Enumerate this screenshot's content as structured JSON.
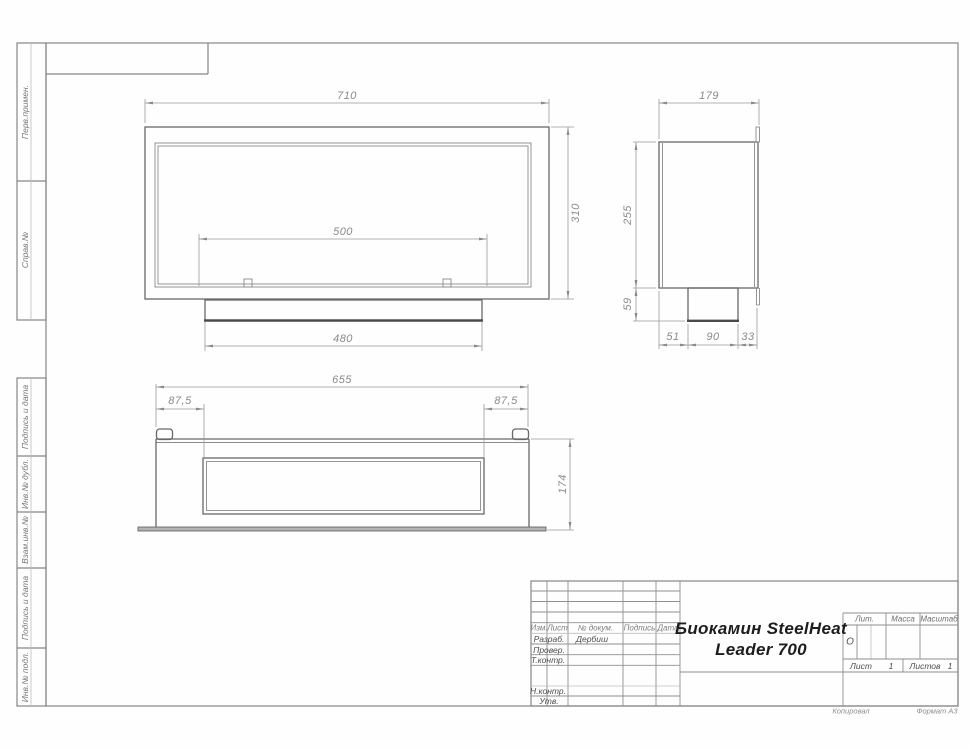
{
  "margin_labels": [
    "Перв.примен.",
    "Справ.№",
    "Подпись и дата",
    "Инв.№ дубл.",
    "Взам.инв.№",
    "Подпись и дата",
    "Инв.№ подл."
  ],
  "views": {
    "front": {
      "width": "710",
      "height": "310",
      "burner_width": "500",
      "tray_width": "480"
    },
    "side": {
      "depth": "179",
      "body_height": "255",
      "tray_height": "59",
      "seg_front": "51",
      "seg_mid": "90",
      "seg_back": "33"
    },
    "bottom": {
      "length": "655",
      "offset_left": "87,5",
      "offset_right": "87,5",
      "height": "174"
    }
  },
  "title_block": {
    "change_cols": [
      "Изм.",
      "Лист",
      "№ докум.",
      "Подпись",
      "Дата"
    ],
    "roles": [
      "Разраб.",
      "Провер.",
      "Т.контр.",
      "Н.контр.",
      "Утв."
    ],
    "developer": "Дербиш",
    "title_line1": "Биокамин SteelHeat",
    "title_line2": "Leader 700",
    "lit": "Лит.",
    "lit_value": "О",
    "mass": "Масса",
    "scale": "Масштаб",
    "sheet": "Лист",
    "sheet_no": "1",
    "sheets": "Листов",
    "sheets_total": "1"
  },
  "footer": {
    "copied": "Копировал",
    "format": "Формат А3"
  },
  "colors": {
    "outline": "#696969",
    "thin": "#8a8a8a",
    "dim": "#9a9a9a",
    "frame": "#868686",
    "thick": "#4a4a4a",
    "title_text": "#1d1d1d"
  }
}
